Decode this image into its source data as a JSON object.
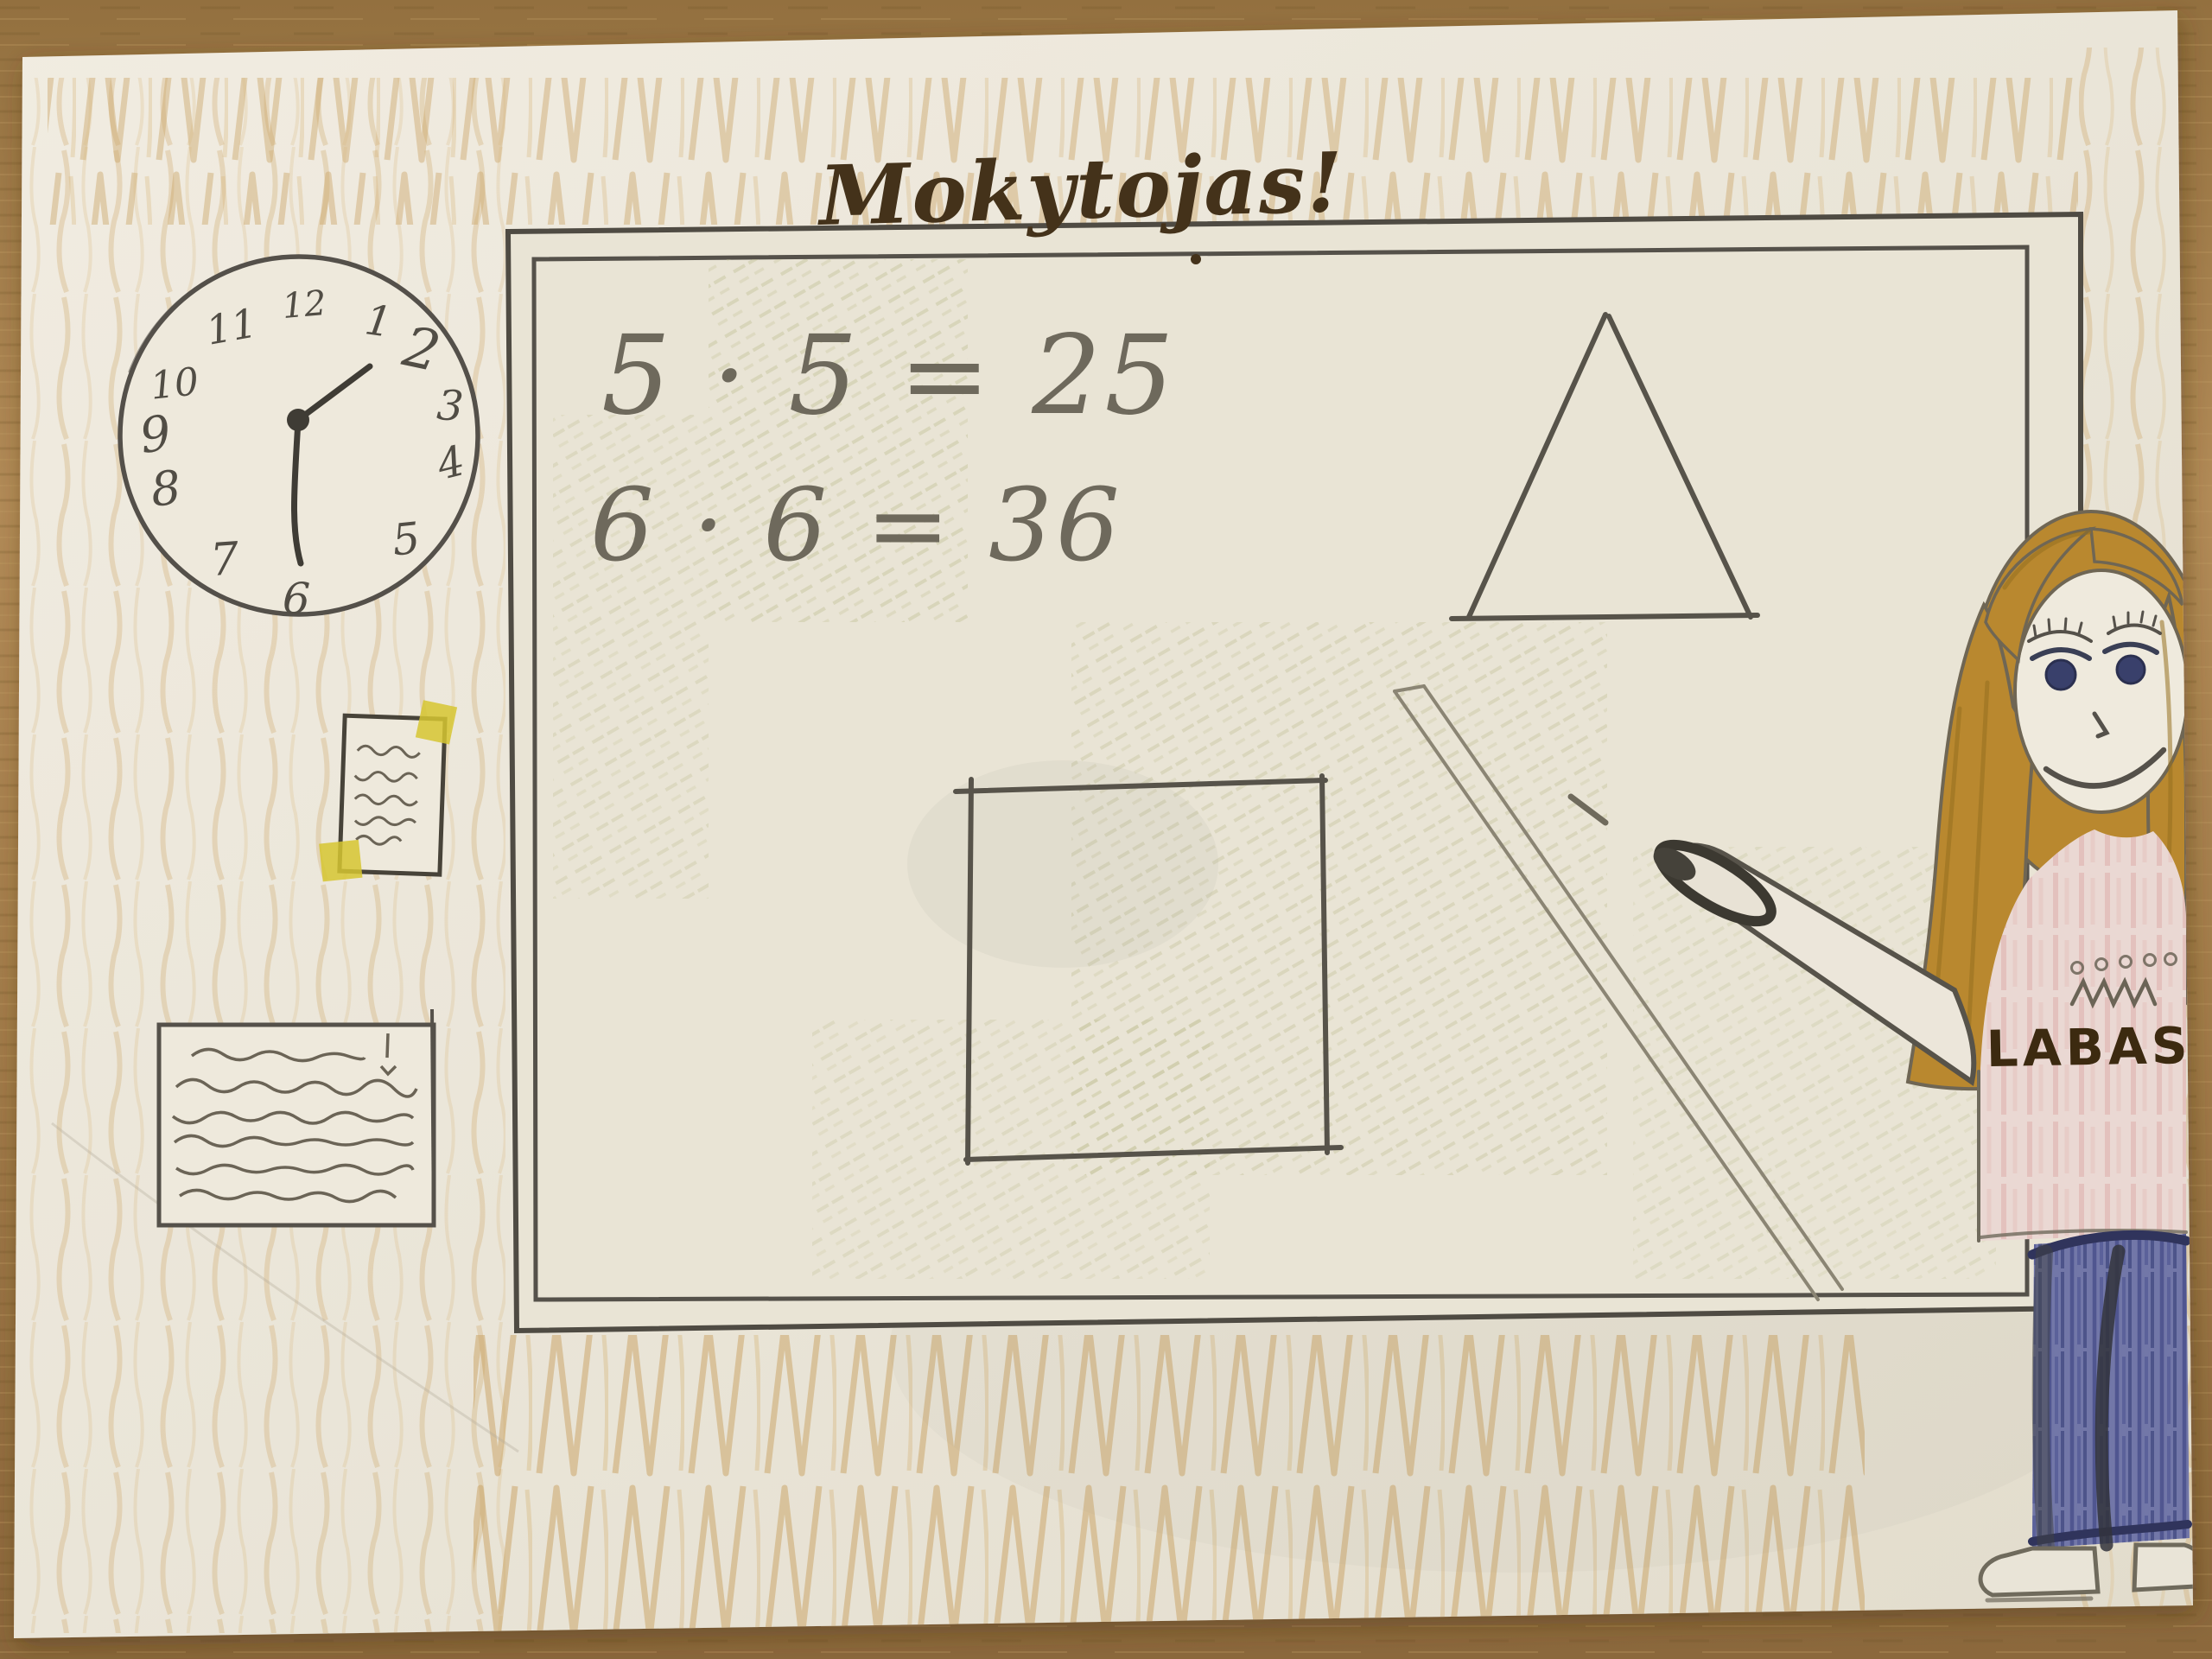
{
  "scene": {
    "title": "Mokytojas!",
    "description": "Child's pencil-and-crayon drawing: a teacher standing beside a whiteboard in a classroom"
  },
  "board": {
    "equations": [
      "5 · 5 = 25",
      "6 · 6 = 36"
    ],
    "shapes": [
      "triangle",
      "square"
    ]
  },
  "clock": {
    "time_shown": "1:30",
    "numerals": [
      "12",
      "1",
      "2",
      "3",
      "4",
      "5",
      "6",
      "7",
      "8",
      "9",
      "10",
      "11"
    ]
  },
  "teacher": {
    "shirt_text": "LABAS",
    "hair_color": "#b9882f",
    "shirt_color": "#ead8d3",
    "jeans_color": "#7277a8"
  },
  "notes": {
    "pinned_note_lines": 5,
    "poster_lines": 6
  },
  "colors": {
    "wood_table": "#a5804e",
    "paper": "#ece7db",
    "crayon_wall": "#c9a263",
    "pencil": "#5f5b50",
    "marker": "#44321a",
    "tape_yellow": "#d6c631",
    "olive_shading": "#b9b98a"
  }
}
